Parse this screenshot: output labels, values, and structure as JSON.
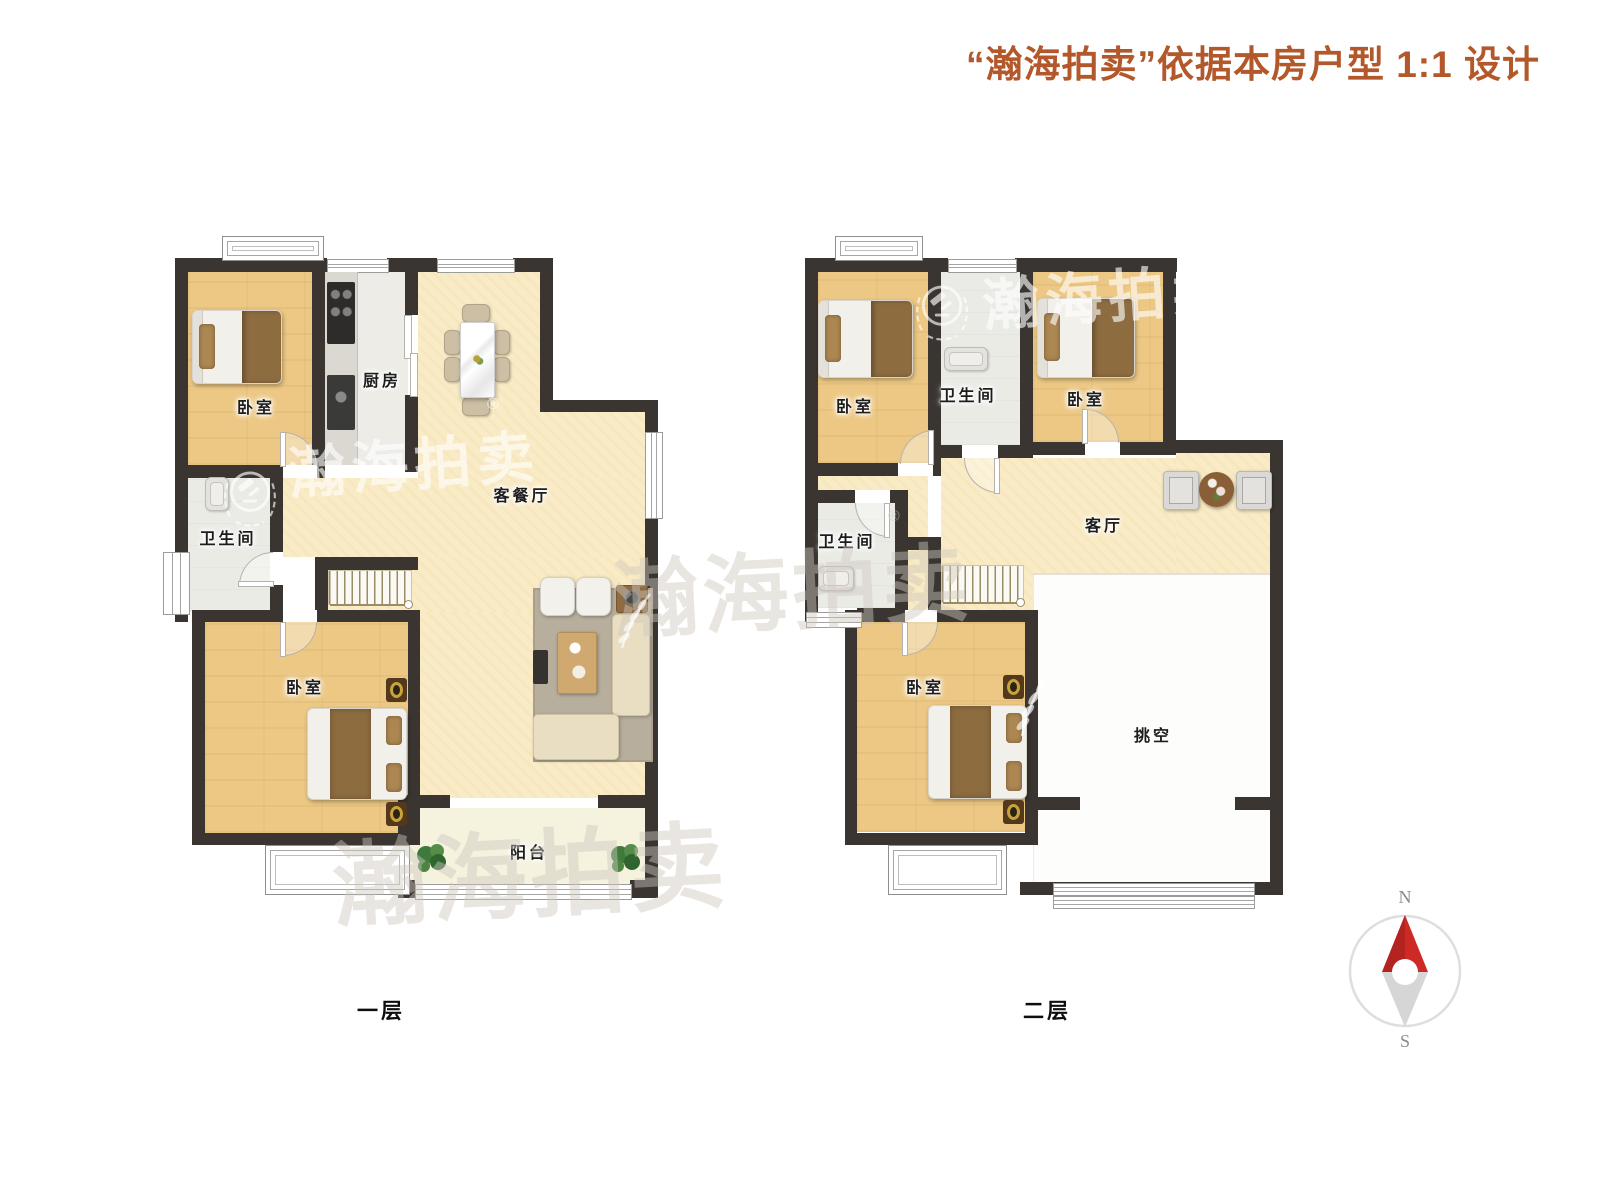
{
  "title": "“瀚海拍卖”依据本房户型 1:1 设计",
  "compass": {
    "north": "N",
    "south": "S"
  },
  "watermark": {
    "brand": "瀚海拍卖",
    "registered": "®"
  },
  "colors": {
    "title_accent": "#b2582a",
    "wall": "#3a3531",
    "wood_floor": "#ecc884",
    "living_floor": "#f8ebc5",
    "wet_floor": "#ebebe6",
    "balcony_floor": "#f5f2de",
    "void_floor": "#fdfdfb",
    "compass_north_arrow": "#ce2a25"
  },
  "floor1": {
    "caption": "一层",
    "rooms": {
      "bedroom_top": "卧室",
      "kitchen": "厨房",
      "living_dining": "客餐厅",
      "bathroom": "卫生间",
      "bedroom_bottom": "卧室",
      "balcony": "阳台"
    }
  },
  "floor2": {
    "caption": "二层",
    "rooms": {
      "bedroom_left": "卧室",
      "bathroom_top": "卫生间",
      "bedroom_right": "卧室",
      "living": "客厅",
      "bathroom_left": "卫生间",
      "bedroom_bottom": "卧室",
      "void": "挑空"
    }
  }
}
